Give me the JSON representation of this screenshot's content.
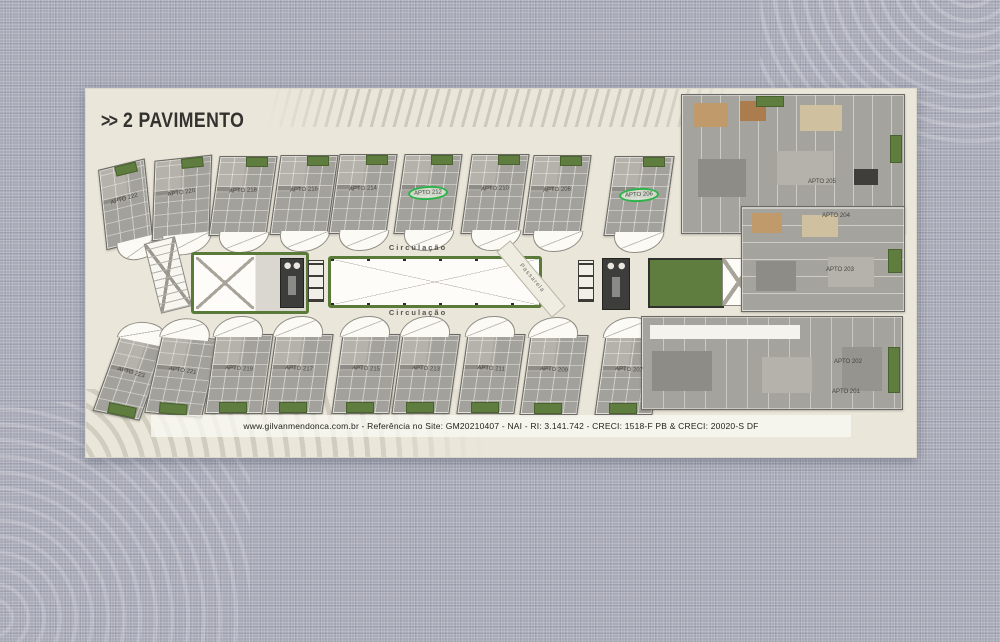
{
  "header": {
    "arrows": ">>",
    "title": "2 PAVIMENTO"
  },
  "plan": {
    "corridor": {
      "top_label": "Circulação",
      "bottom_label": "Circulação",
      "walkway_label": "Passarela"
    },
    "top_row": [
      {
        "label": "APTO 222",
        "highlighted": false
      },
      {
        "label": "APTO 220",
        "highlighted": false
      },
      {
        "label": "APTO 218",
        "highlighted": false
      },
      {
        "label": "APTO 216",
        "highlighted": false
      },
      {
        "label": "APTO 214",
        "highlighted": false
      },
      {
        "label": "APTO 212",
        "highlighted": true
      },
      {
        "label": "APTO 210",
        "highlighted": false
      },
      {
        "label": "APTO 208",
        "highlighted": false
      },
      {
        "label": "APTO 206",
        "highlighted": true
      }
    ],
    "bottom_row": [
      {
        "label": "APTO 223",
        "highlighted": false
      },
      {
        "label": "APTO 221",
        "highlighted": false
      },
      {
        "label": "APTO 219",
        "highlighted": false
      },
      {
        "label": "APTO 217",
        "highlighted": false
      },
      {
        "label": "APTO 215",
        "highlighted": false
      },
      {
        "label": "APTO 213",
        "highlighted": false
      },
      {
        "label": "APTO 211",
        "highlighted": false
      },
      {
        "label": "APTO 209",
        "highlighted": false
      },
      {
        "label": "APTO 207",
        "highlighted": false
      }
    ],
    "right_units": [
      {
        "label": "APTO 205"
      },
      {
        "label": "APTO 204"
      },
      {
        "label": "APTO 203"
      },
      {
        "label": "APTO 202"
      },
      {
        "label": "APTO 201"
      }
    ]
  },
  "footer": {
    "text": "www.gilvanmendonca.com.br - Referência no Site: GM20210407  -  NAI - RI: 3.141.742 - CRECI: 1518-F PB & CRECI: 20020-S DF"
  },
  "colors": {
    "background": "#a8aab7",
    "card": "#eae6d9",
    "unit_gray": "#a3a19b",
    "garden_green": "#5f7d3e",
    "highlight_green": "#2eb34b",
    "core_dark": "#3d3d3b",
    "text_dark": "#33322f"
  }
}
